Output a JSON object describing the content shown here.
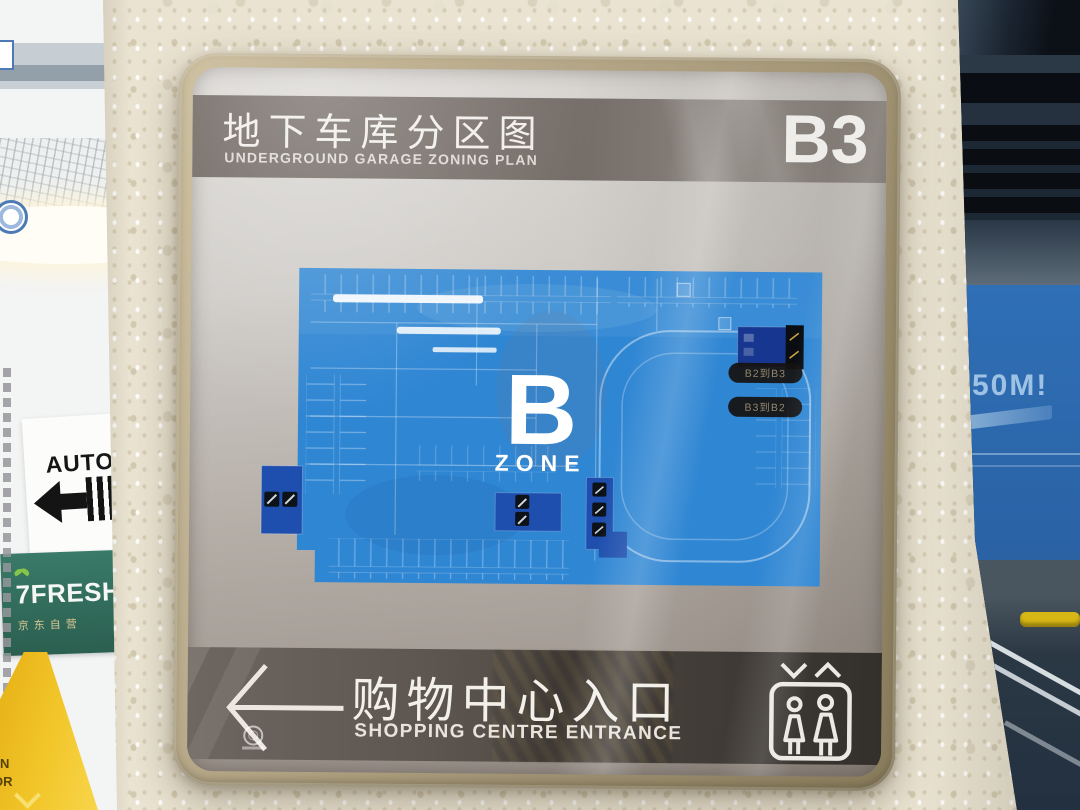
{
  "sign": {
    "header": {
      "title_zh": "地下车库分区图",
      "title_en": "UNDERGROUND GARAGE ZONING PLAN",
      "level": "B3"
    },
    "map": {
      "zone_letter": "B",
      "zone_word": "ZONE",
      "ramp_labels": [
        {
          "label": "B2到B3"
        },
        {
          "label": "B3到B2"
        }
      ]
    },
    "footer": {
      "direction_zh": "购物中心入口",
      "direction_en": "SHOPPING CENTRE ENTRANCE"
    }
  },
  "environment": {
    "auto_sign": {
      "label": "AUTO",
      "partial_zh": "自"
    },
    "fresh_sign": {
      "brand": "7FRESH",
      "subtitle_zh": "京东自营"
    },
    "pillar_sign": {
      "distance": "50M!"
    },
    "caution_sign": {
      "fragment_top": "N",
      "fragment_bottom": "OR"
    }
  },
  "colors": {
    "frame_tan": "#b3a585",
    "header_bar": "#6f6660",
    "map_blue": "#2f86d3",
    "dark_box_blue": "#1e4fae",
    "footer_bar_right": "#33302c",
    "fresh_green": "#2f6a59",
    "pillar_blue": "#2d6bb0",
    "caution_yellow": "#e9b822"
  }
}
